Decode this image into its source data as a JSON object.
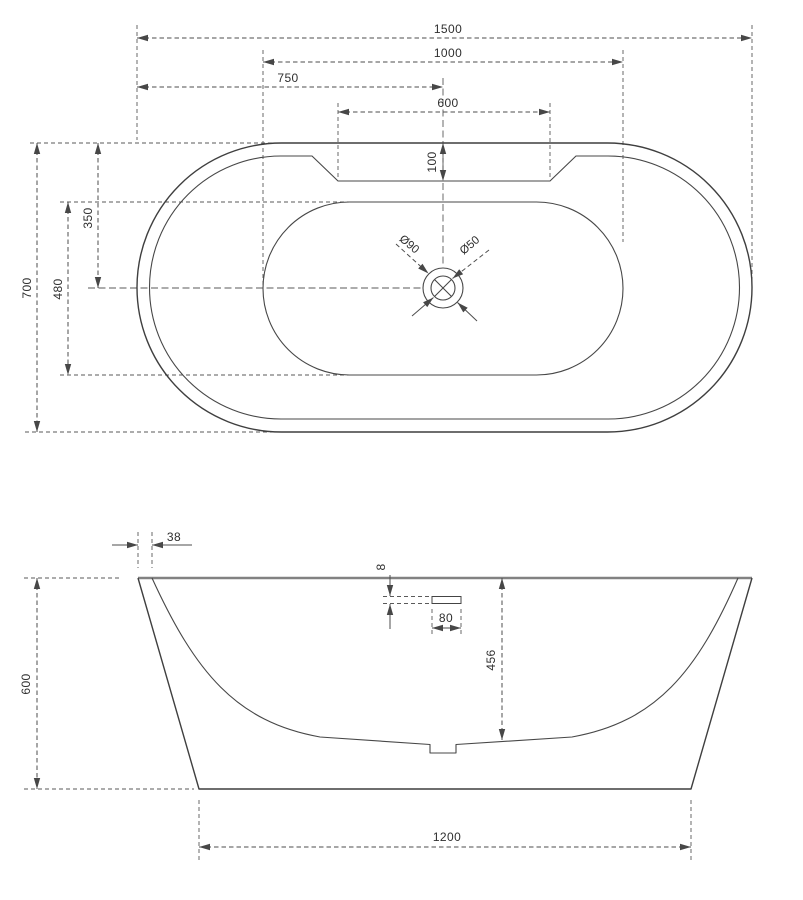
{
  "meta": {
    "background": "#ffffff",
    "line_color": "#3f3f3f",
    "dim_color": "#4d4d4d",
    "drawing_type": "bathtub dimensional drawing, plan view and front elevation"
  },
  "top_view": {
    "labels": {
      "overall_length": "1500",
      "inner_basin_length": "1000",
      "half_length": "750",
      "deck_notch_width": "600",
      "deck_notch_depth": "100",
      "overall_width": "700",
      "inner_basin_width": "480",
      "drain_offset_from_edge": "350",
      "drain_outer_diameter": "Ø90",
      "drain_hole_diameter": "Ø50"
    }
  },
  "front_view": {
    "labels": {
      "rim_thickness": "38",
      "overall_height": "600",
      "overflow_offset": "8",
      "overflow_width": "80",
      "inner_depth": "456",
      "base_length": "1200"
    }
  }
}
